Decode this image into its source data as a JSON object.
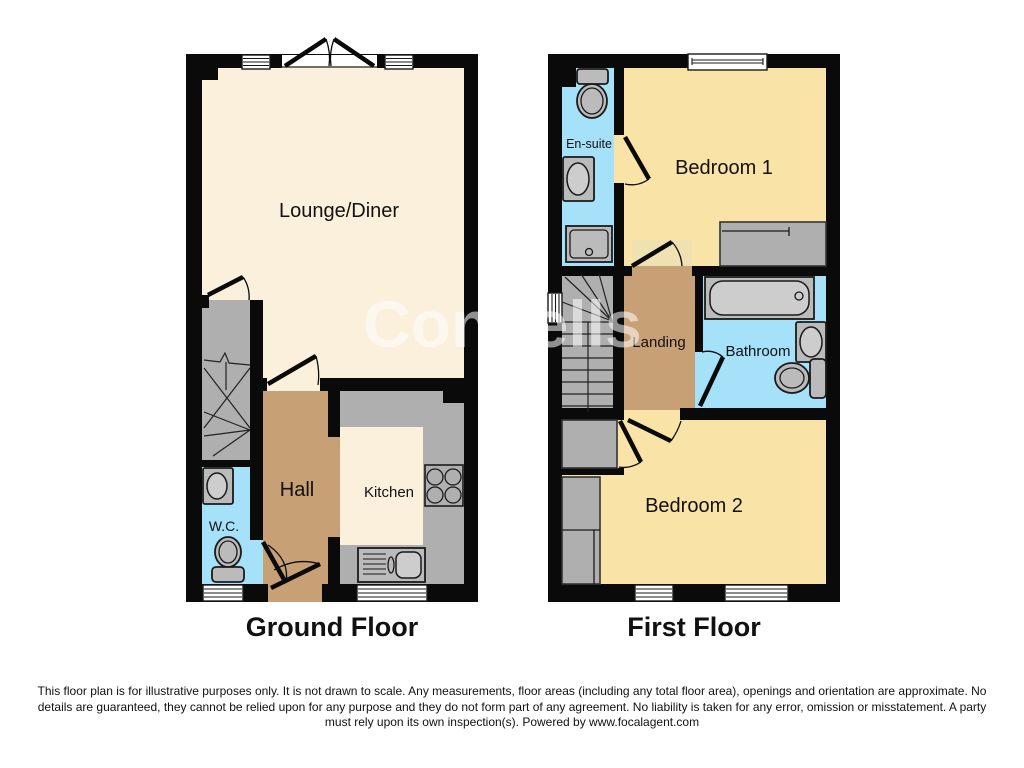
{
  "watermark": {
    "text": "Connells"
  },
  "colors": {
    "wall": "#0a0a0a",
    "cream": "#FAF0DB",
    "yellow": "#FAE3A6",
    "yellow_pale": "#F0E1B2",
    "tan": "#C7A076",
    "blue": "#A5E2F9",
    "gray": "#AFAFAF",
    "fixture": "#BBBBBB",
    "fixture_light": "#CDCDCD",
    "line": "#1a1a1a",
    "text": "#111111",
    "watermark": "rgba(255,255,255,0.55)"
  },
  "floors": {
    "ground": {
      "title": "Ground Floor",
      "rooms": {
        "lounge": "Lounge/Diner",
        "hall": "Hall",
        "kitchen": "Kitchen",
        "wc": "W.C."
      }
    },
    "first": {
      "title": "First Floor",
      "rooms": {
        "bedroom1": "Bedroom 1",
        "ensuite": "En-suite",
        "landing": "Landing",
        "bathroom": "Bathroom",
        "bedroom2": "Bedroom 2"
      }
    }
  },
  "disclaimer": {
    "lines": [
      "This floor plan is for illustrative purposes only. It is not drawn to scale. Any measurements, floor areas (including any total floor area), openings and orientation are approximate. No",
      "details are guaranteed, they cannot be relied upon for any purpose and they do not form part of any agreement. No liability is taken for any error, omission or misstatement. A party",
      "must rely upon its own inspection(s). Powered by www.focalagent.com"
    ]
  }
}
